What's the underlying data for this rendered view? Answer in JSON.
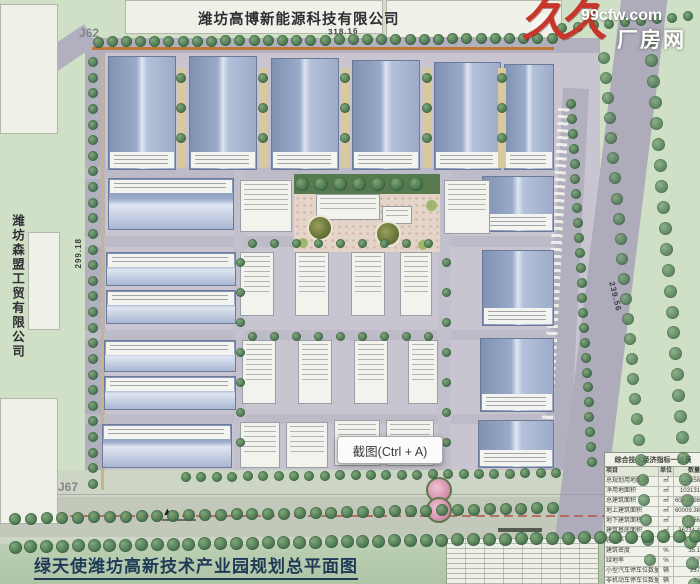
{
  "colors": {
    "grass": "#cfe0c6",
    "road": "#b2afbe",
    "roof_blue": "#9aaac8",
    "watermark_red": "#c8352a",
    "title_bar": "#b3c9aa",
    "title_text": "#1e3a56"
  },
  "watermark": {
    "logo_text": "久久",
    "site_url": "99cfw.com",
    "brand_name": "厂房网"
  },
  "plan": {
    "top_company_label": "潍坊高博新能源科技有限公司",
    "left_company_label": "潍坊森盟工贸有限公司",
    "title": "绿天使潍坊高新技术产业园规划总平面图",
    "road_labels": {
      "j62": "J62",
      "j67": "J67"
    },
    "dimensions": {
      "top": "318.16",
      "left": "299.18",
      "right": "239.56"
    },
    "entrance_marker": "▲"
  },
  "screenshot_tooltip": {
    "label": "截图(Ctrl + A)"
  },
  "indicator_table": {
    "title": "综合技术经济指标一览表",
    "headers": [
      "项目",
      "单位",
      "数量"
    ],
    "rows": [
      {
        "item": "总规划用地面积",
        "unit": "㎡",
        "value": "110358"
      },
      {
        "item": "净用地面积",
        "unit": "㎡",
        "value": "103131"
      },
      {
        "item": "总建筑面积",
        "unit": "㎡",
        "value": "60499.98"
      },
      {
        "item": "地上建筑面积",
        "unit": "㎡",
        "value": "60009.38"
      },
      {
        "item": "地下建筑面积",
        "unit": "㎡",
        "value": "389.86"
      },
      {
        "item": "建筑基底面积",
        "unit": "㎡",
        "value": "36234.4"
      },
      {
        "item": "容积率",
        "unit": "",
        "value": "1.086"
      },
      {
        "item": "建筑密度",
        "unit": "%",
        "value": "35.1"
      },
      {
        "item": "绿地率",
        "unit": "%",
        "value": "15.7"
      },
      {
        "item": "小型汽车停车位数量",
        "unit": "辆",
        "value": "237"
      },
      {
        "item": "非机动车停车位数量",
        "unit": "辆",
        "value": "10"
      },
      {
        "item": "停车率",
        "unit": "%",
        "value": "13.7"
      }
    ]
  }
}
